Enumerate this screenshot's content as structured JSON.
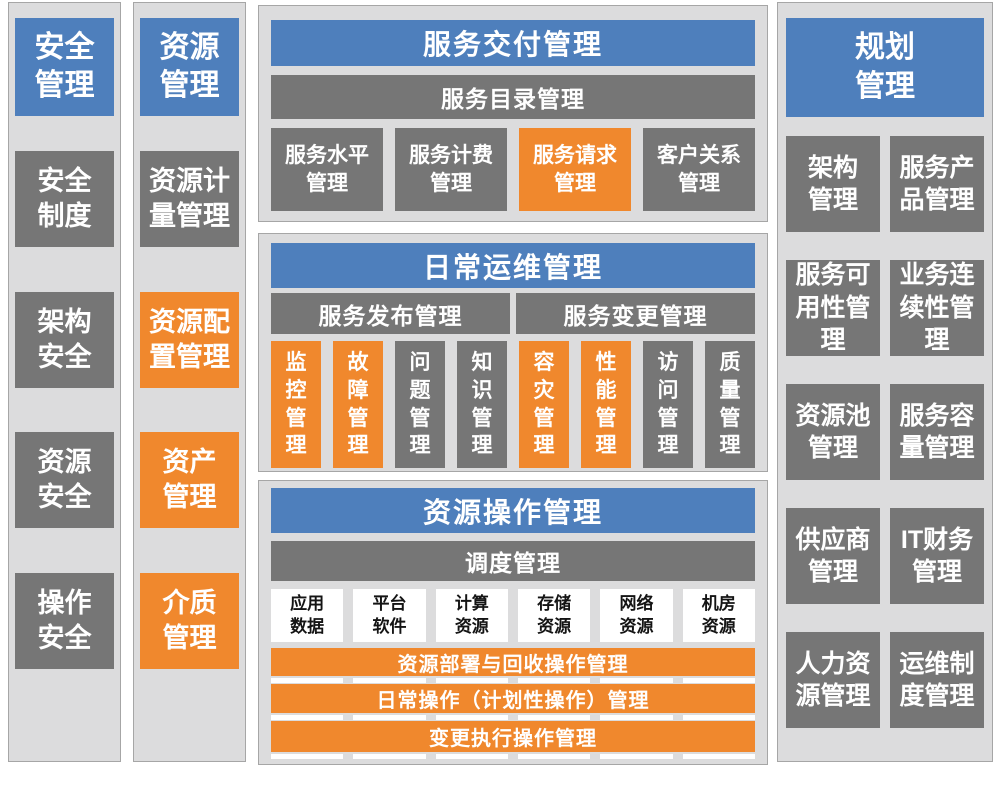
{
  "colors": {
    "header_blue": "#4E7FBC",
    "block_gray": "#767676",
    "highlight_orange": "#F0882D",
    "panel_background": "#DCDCDD",
    "panel_border": "#A6A6A6",
    "white_block": "#FFFFFF"
  },
  "security": {
    "header": "安全\n管理",
    "items": [
      "安全\n制度",
      "架构\n安全",
      "资源\n安全",
      "操作\n安全"
    ]
  },
  "resource": {
    "header": "资源\n管理",
    "items": [
      {
        "label": "资源计\n量管理",
        "color": "gray"
      },
      {
        "label": "资源配\n置管理",
        "color": "orange"
      },
      {
        "label": "资产\n管理",
        "color": "orange"
      },
      {
        "label": "介质\n管理",
        "color": "orange"
      }
    ]
  },
  "service_delivery": {
    "header": "服务交付管理",
    "catalog_bar": "服务目录管理",
    "items": [
      {
        "label": "服务水平\n管理",
        "color": "gray"
      },
      {
        "label": "服务计费\n管理",
        "color": "gray"
      },
      {
        "label": "服务请求\n管理",
        "color": "orange"
      },
      {
        "label": "客户关系\n管理",
        "color": "gray"
      }
    ]
  },
  "daily_ops": {
    "header": "日常运维管理",
    "release_bar": "服务发布管理",
    "change_bar": "服务变更管理",
    "items": [
      {
        "label": "监\n控\n管\n理",
        "color": "orange"
      },
      {
        "label": "故\n障\n管\n理",
        "color": "orange"
      },
      {
        "label": "问\n题\n管\n理",
        "color": "gray"
      },
      {
        "label": "知\n识\n管\n理",
        "color": "gray"
      },
      {
        "label": "容\n灾\n管\n理",
        "color": "orange"
      },
      {
        "label": "性\n能\n管\n理",
        "color": "orange"
      },
      {
        "label": "访\n问\n管\n理",
        "color": "gray"
      },
      {
        "label": "质\n量\n管\n理",
        "color": "gray"
      }
    ]
  },
  "resource_ops": {
    "header": "资源操作管理",
    "dispatch_bar": "调度管理",
    "resources": [
      "应用\n数据",
      "平台\n软件",
      "计算\n资源",
      "存储\n资源",
      "网络\n资源",
      "机房\n资源"
    ],
    "operation_bars": [
      "资源部署与回收操作管理",
      "日常操作（计划性操作）管理",
      "变更执行操作管理"
    ]
  },
  "planning": {
    "header": "规划\n管理",
    "items": [
      "架构\n管理",
      "服务产\n品管理",
      "服务可\n用性管\n理",
      "业务连\n续性管\n理",
      "资源池\n管理",
      "服务容\n量管理",
      "供应商\n管理",
      "IT财务\n管理",
      "人力资\n源管理",
      "运维制\n度管理"
    ]
  }
}
